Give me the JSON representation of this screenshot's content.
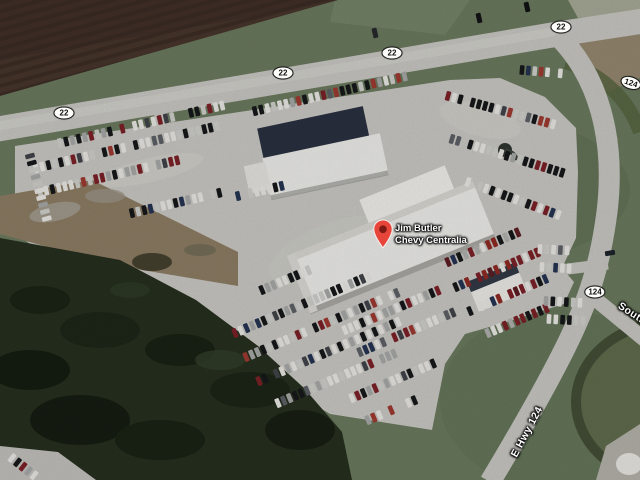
{
  "map": {
    "marker": {
      "line1": "Jim Butler",
      "line2": "Chevy Centralia",
      "x": 383,
      "y": 249,
      "pin_color": "#e8453a",
      "pin_dot_color": "#7e1a14"
    },
    "route_shields": [
      {
        "label": "22",
        "x": 64,
        "y": 113,
        "angle": 0
      },
      {
        "label": "22",
        "x": 283,
        "y": 73,
        "angle": 0
      },
      {
        "label": "22",
        "x": 392,
        "y": 53,
        "angle": 0
      },
      {
        "label": "22",
        "x": 561,
        "y": 27,
        "angle": 0
      },
      {
        "label": "124",
        "x": 631,
        "y": 83,
        "angle": 18
      },
      {
        "label": "124",
        "x": 595,
        "y": 292,
        "angle": 0
      }
    ],
    "road_labels": [
      {
        "text": "Southgate",
        "x": 642,
        "y": 320,
        "angle": 33
      },
      {
        "text": "E Hwy 124",
        "x": 527,
        "y": 432,
        "angle": -62
      }
    ],
    "palette": {
      "grass": "#6b7a5f",
      "grass_dark": "#5f7054",
      "field_brown": "#46342b",
      "trees": "#26301f",
      "pavement": "#cac9c4",
      "road": "#c9c8c3",
      "dirt": "#8d7d64",
      "building": "#eeedea",
      "roof_dark": "#2a3140"
    }
  }
}
